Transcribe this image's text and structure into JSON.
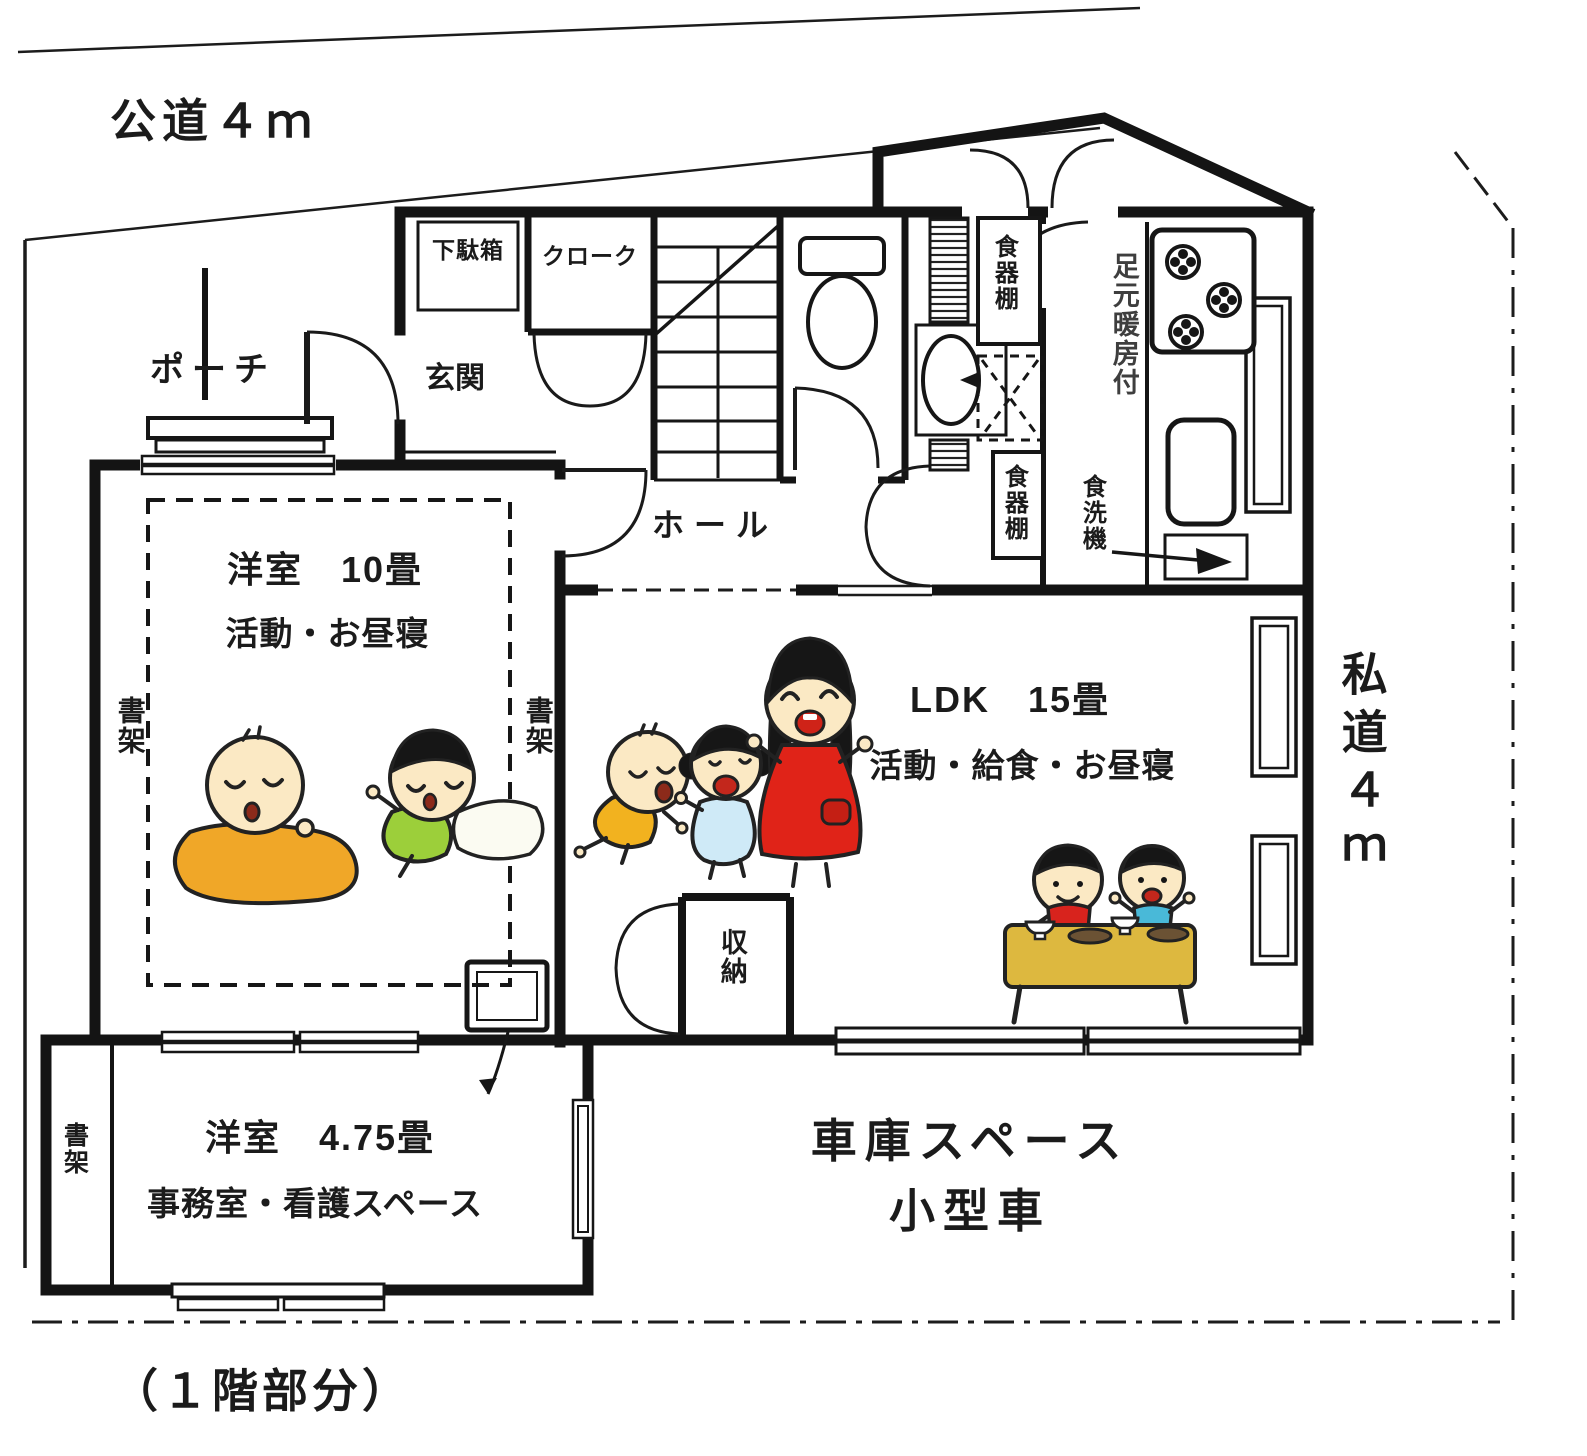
{
  "palette": {
    "ink": "#181818",
    "paper": "#ffffff"
  },
  "site": {
    "public_road_label": "公道４ｍ",
    "private_road_label": "私道４ｍ",
    "floor_caption": "（１階部分）"
  },
  "rooms": {
    "porch": "ポーチ",
    "entrance": "玄関",
    "shoe_cabinet": "下駄箱",
    "cloak": "クローク",
    "hall": "ホール",
    "storage": "収納",
    "playroom": {
      "title": "洋室　10畳",
      "use": "活動・お昼寝"
    },
    "ldk": {
      "title": "LDK　15畳",
      "use": "活動・給食・お昼寝"
    },
    "office": {
      "title": "洋室　4.75畳",
      "use": "事務室・看護スペース"
    },
    "garage": {
      "line1": "車庫スペース",
      "line2": "小型車"
    }
  },
  "fixtures": {
    "bookshelf": "書架",
    "dish_cabinet": "食器棚",
    "foot_heating": "足元暖房付",
    "dishwasher": "食洗機"
  },
  "figures": {
    "colors": {
      "skin": "#fbe9c4",
      "hair": "#161616",
      "caregiver_dress": "#e02318",
      "girl_dress": "#cfeaf7",
      "crawl_baby_romper": "#f2b21f",
      "blanket": "#f0a728",
      "toddler_shirt": "#9ccf3a",
      "boy_red": "#d8231d",
      "boy_blue": "#49b9d8",
      "table": "#ddb83f",
      "pillow": "#fbfbf2",
      "mouth": "#c3271c"
    }
  }
}
